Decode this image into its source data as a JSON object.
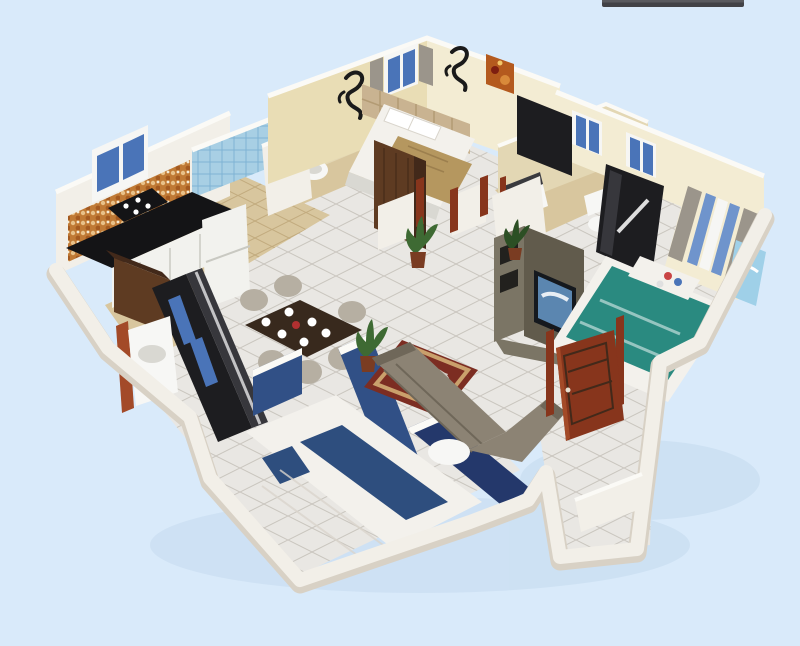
{
  "scene": {
    "type": "3d-floor-plan-render",
    "view": "isometric-cutaway",
    "visible_text": [],
    "rooms": [
      {
        "name": "master-bedroom",
        "items": [
          "double-bed",
          "tufted-headboard",
          "wardrobe",
          "window",
          "dragon-wall-decals",
          "wall-painting",
          "toilet-nook"
        ]
      },
      {
        "name": "kitchen",
        "items": [
          "window",
          "mosaic-backsplash",
          "black-countertop",
          "gas-hob",
          "white-cabinets",
          "fridge",
          "wood-island",
          "blue-glass-tile-wall"
        ]
      },
      {
        "name": "dining-area",
        "items": [
          "dining-table",
          "six-chairs",
          "plates",
          "sideboard-wardrobe",
          "navy-half-walls"
        ]
      },
      {
        "name": "living-room",
        "items": [
          "sectional-sofa",
          "red-rug",
          "coffee-table",
          "ottoman",
          "tv-unit",
          "potted-plants",
          "navy-accent-wall"
        ]
      },
      {
        "name": "bedroom-right",
        "items": [
          "teal-bed",
          "black-wardrobe",
          "striped-curtain-window",
          "two-windows",
          "blue-artwork"
        ]
      },
      {
        "name": "bedroom-bottom",
        "items": [
          "white-bed-blue-runner",
          "navy-walls",
          "dark-wardrobe"
        ]
      },
      {
        "name": "bathroom-middle",
        "items": [
          "washbasin",
          "toilet"
        ]
      },
      {
        "name": "utility",
        "items": [
          "washbasin",
          "wood-trim"
        ]
      },
      {
        "name": "entry",
        "items": [
          "open-wooden-door",
          "corridor"
        ]
      }
    ]
  },
  "colors": {
    "bg": "#d9eafa",
    "topbar": "#424246",
    "wall_white": "#f2efe8",
    "wall_shade": "#d8d1c5",
    "wall_bright": "#fbfaf6",
    "wall_cream": "#e9ddb5",
    "wall_cream_light": "#f3ecd3",
    "wall_beige": "#e3d7b4",
    "wall_navy": "#315086",
    "wall_navy_shade": "#24386b",
    "floor_marble": "#e9e7e3",
    "floor_beige": "#d8c69e",
    "counter_black": "#141416",
    "cabinet_white": "#f2f2ee",
    "mosaic_orange": "#c07a35",
    "glass_blue": "#a8cfe4",
    "window_blue": "#4a74b8",
    "window_frame": "#f6f6f4",
    "wood_brown": "#5e3b22",
    "wood_dark": "#42291a",
    "door_red": "#87351c",
    "door_red_light": "#a34a28",
    "bed_white": "#f3f1ec",
    "blanket_tan": "#b5975f",
    "blanket_teal": "#2a8a80",
    "runner_blue": "#2e4e7e",
    "headboard_beige": "#c9b391",
    "sofa_taupe": "#8c8374",
    "sofa_shade": "#6f6759",
    "rug_red": "#7c2d22",
    "rug_trim": "#caa06c",
    "rug_center": "#cfcac2",
    "tv_olive": "#7b7565",
    "tv_olive_dark": "#615b4c",
    "tv_screen": "#15191e",
    "tv_screen_img": "#5b86b0",
    "plant_green": "#3e6a33",
    "plant_dark": "#2c4f24",
    "pot_red": "#7a3c22",
    "art_orange": "#b45a1e",
    "art_blue": "#9fd0e8",
    "curtain_blue": "#6f94cc",
    "curtain_gray": "#9b958b",
    "decal_black": "#1a1a1a",
    "fixture_white": "#f7f7f5",
    "fixture_shade": "#d9d8d2",
    "unit_black": "#1d1d20",
    "unit_gray": "#37373c",
    "table_brown": "#38291d",
    "chair_beige": "#b6afa2",
    "shadow_blue": "#b9d2e8"
  }
}
